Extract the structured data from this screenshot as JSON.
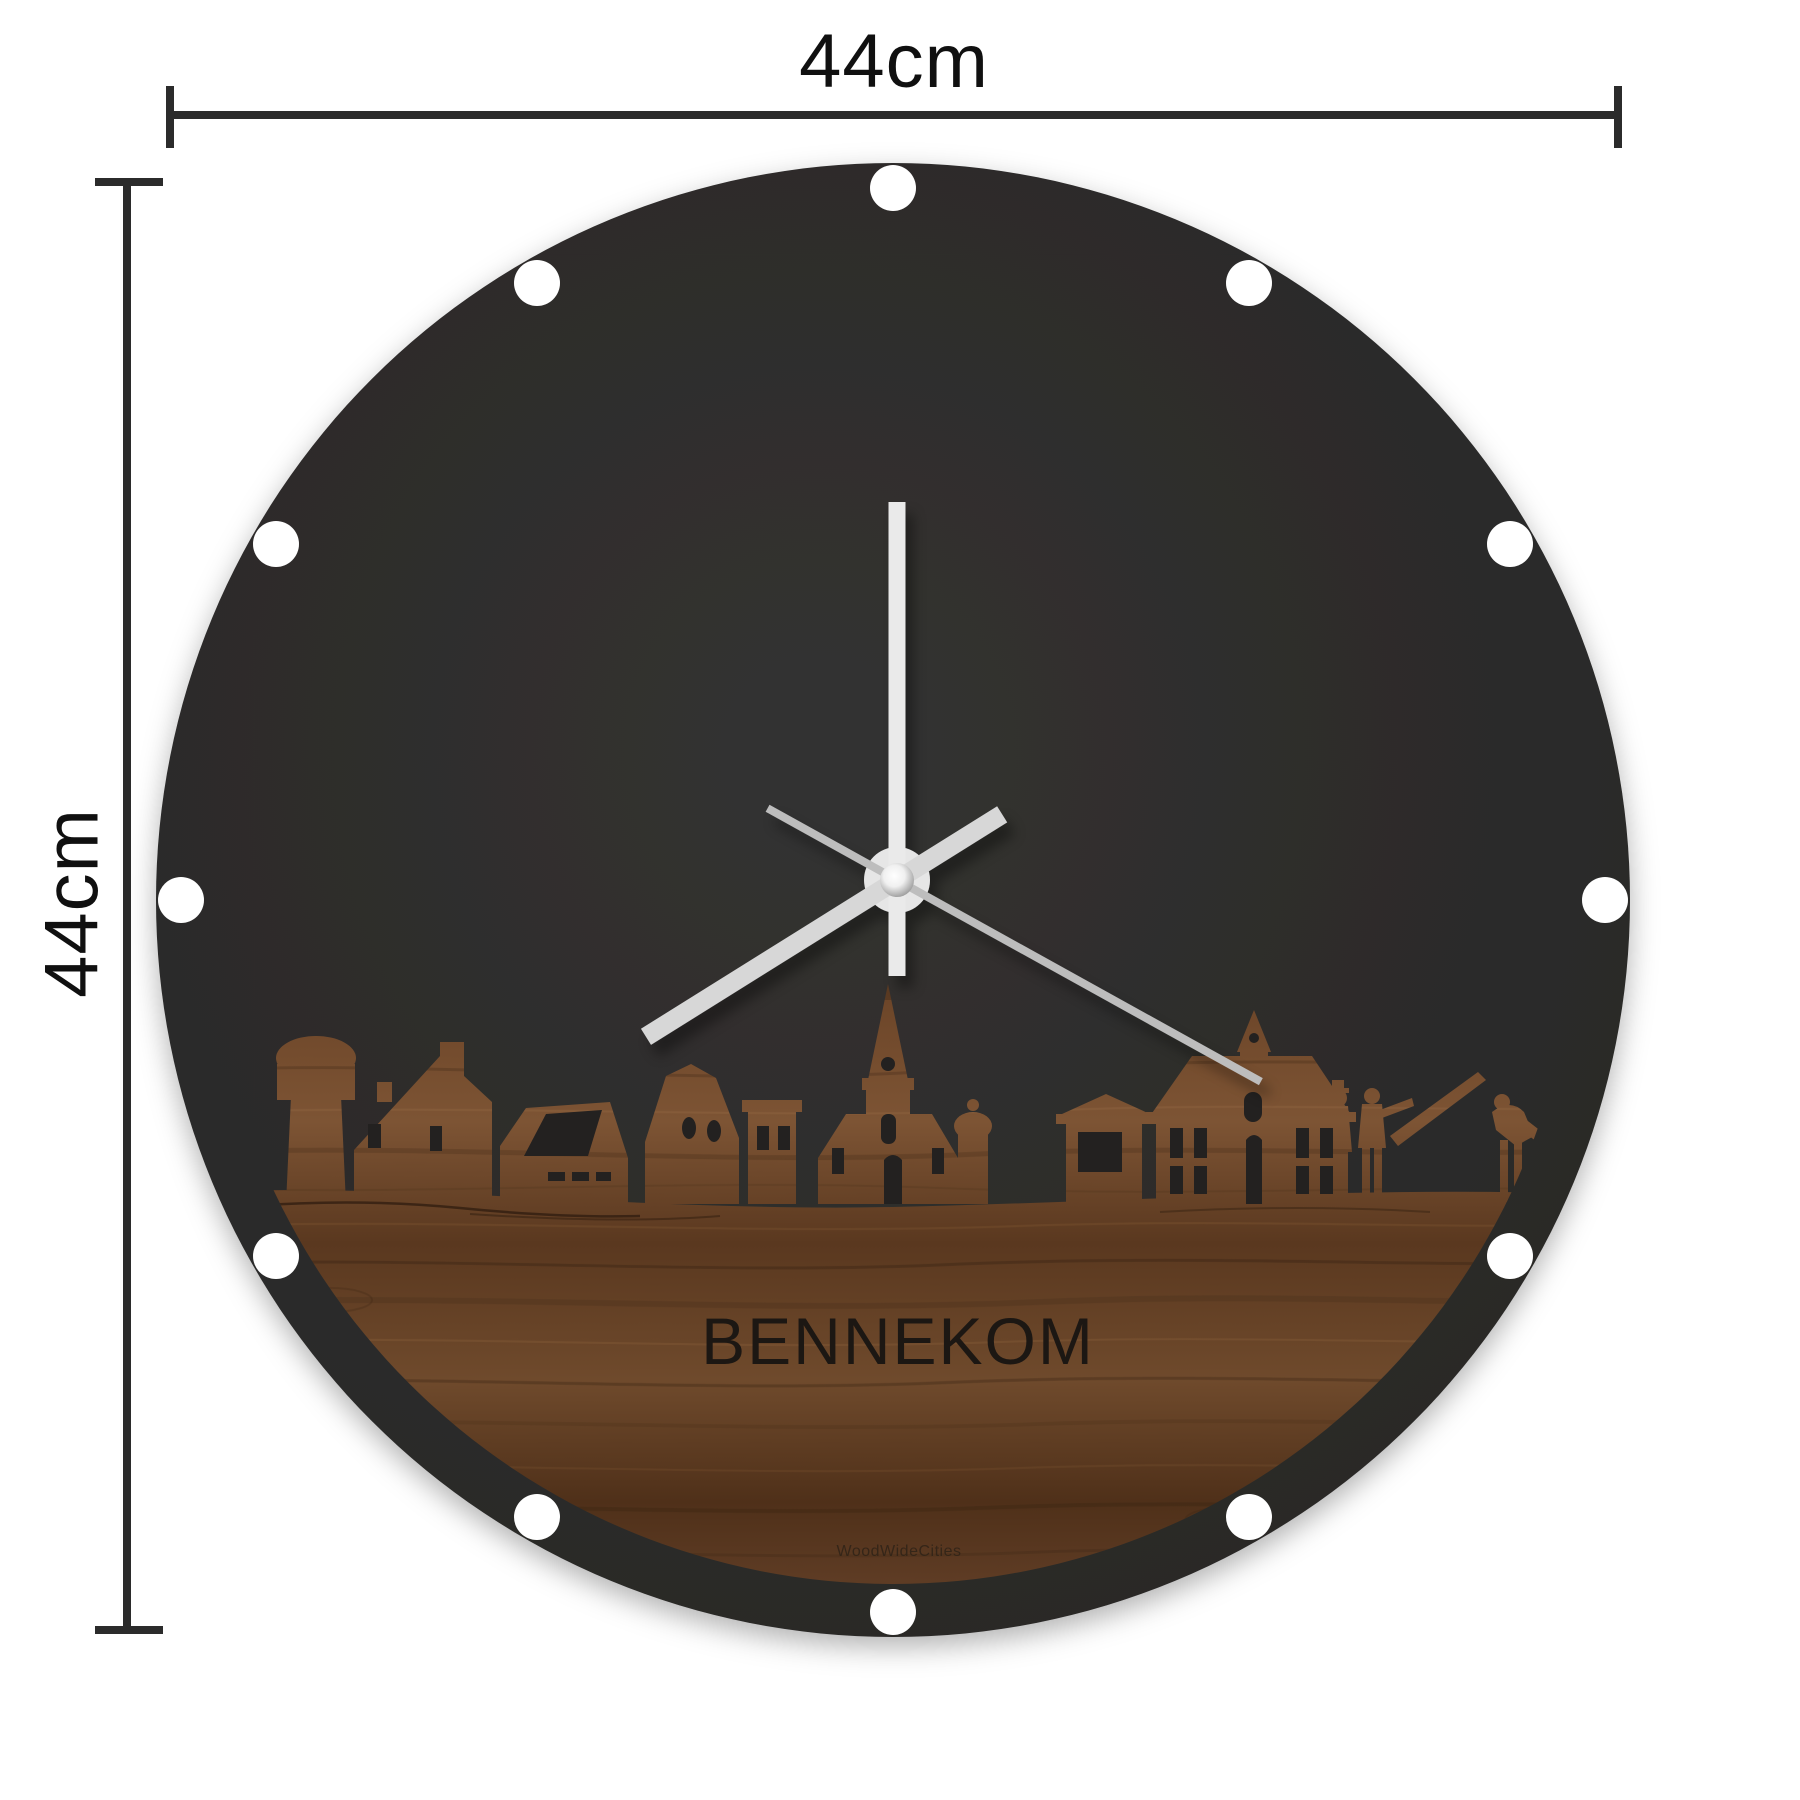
{
  "dimensions": {
    "width_label": "44cm",
    "height_label": "44cm"
  },
  "clock": {
    "city_text": "BENNEKOM",
    "brand_text": "WoodWideCities",
    "time_reading": {
      "minute_hand_angle_deg": 0,
      "hour_hand_angle_deg": 238,
      "second_hand_angle_deg": 119
    }
  },
  "theme": {
    "dimension_line": "#2b2b2b",
    "face": "#2b2a29",
    "minute_hand": "#eaeaea",
    "hour_hand": "#d7d7d7",
    "second_hand": "#bdbdbd",
    "cutout": "#232120",
    "wood_light": "#8a5f3c",
    "wood_mid": "#6e4a2e",
    "wood_dark": "#4a2c18"
  }
}
